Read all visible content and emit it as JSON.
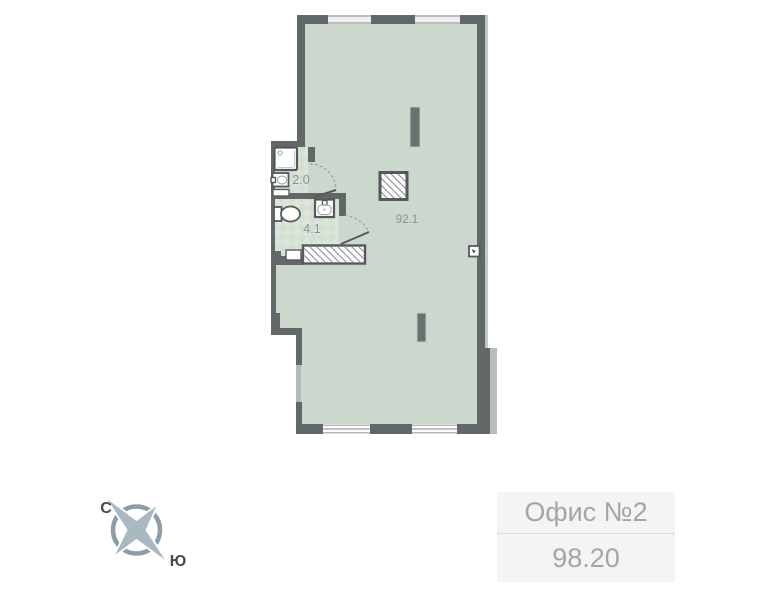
{
  "floor_plan": {
    "rooms": [
      {
        "name": "shower-room",
        "area_label": "2.0"
      },
      {
        "name": "wc",
        "area_label": "4.1"
      },
      {
        "name": "main-space",
        "area_label": "92.1"
      }
    ]
  },
  "compass": {
    "north_label": "С",
    "south_label": "Ю"
  },
  "unit_card": {
    "title": "Офис №2",
    "area_value": "98.20"
  },
  "colors": {
    "wall": "#626768",
    "floor_fill": "#ccd8cd",
    "tile_light": "#dce6d8",
    "tile_dark": "#d2dfd2",
    "window_line": "#9aa1a0",
    "compass": "#8e9ca6",
    "compass_star": "#aab8c2",
    "card_bg": "#f4f4f4",
    "card_text": "#a5a5a5",
    "room_label_text": "#8b9292"
  }
}
